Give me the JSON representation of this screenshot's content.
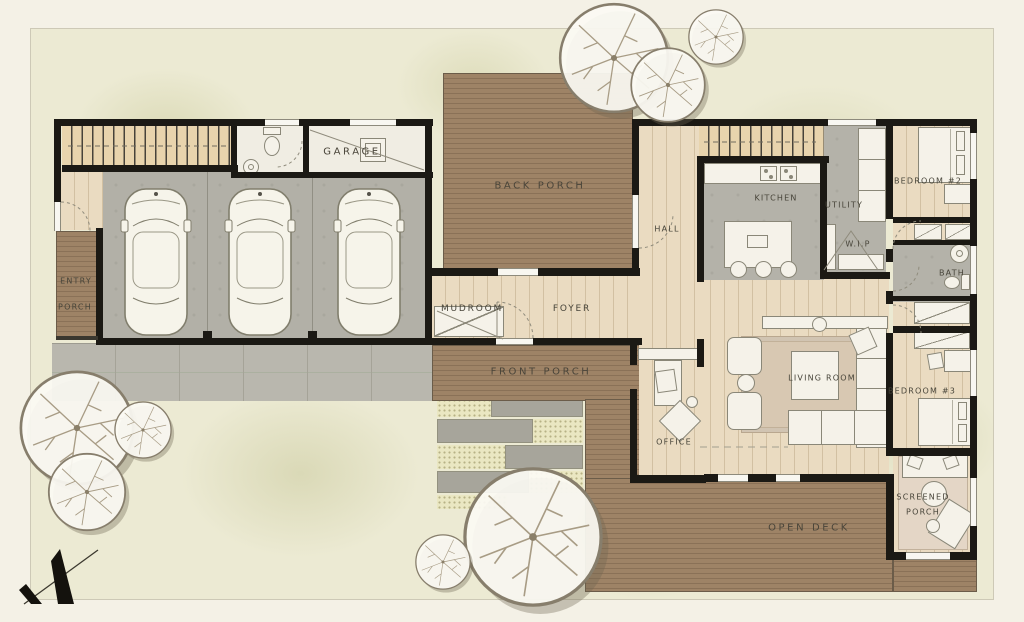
{
  "plan": {
    "labels": {
      "garage": "GARAGE",
      "entry_line1": "ENTRY",
      "entry_line2": "PORCH",
      "back_porch": "BACK PORCH",
      "hall": "HALL",
      "kitchen": "KITCHEN",
      "utility": "UTILITY",
      "wip": "W.I.P",
      "bedroom2": "BEDROOM #2",
      "bath": "BATH",
      "mudroom": "MUDROOM",
      "foyer": "FOYER",
      "front_porch": "FRONT PORCH",
      "office": "OFFICE",
      "living_room": "LIVING ROOM",
      "bedroom3": "BEDROOM #3",
      "screened_line1": "SCREENED",
      "screened_line2": "PORCH",
      "open_deck": "OPEN DECK"
    },
    "palette": {
      "paper": "#f4f1e6",
      "lawn": "#ecead3",
      "deck_wood": "#9e8366",
      "interior_wood": "#eadbc1",
      "stone_gray": "#b4b2a9",
      "wall": "#1b1914",
      "label_text": "#474439"
    }
  }
}
